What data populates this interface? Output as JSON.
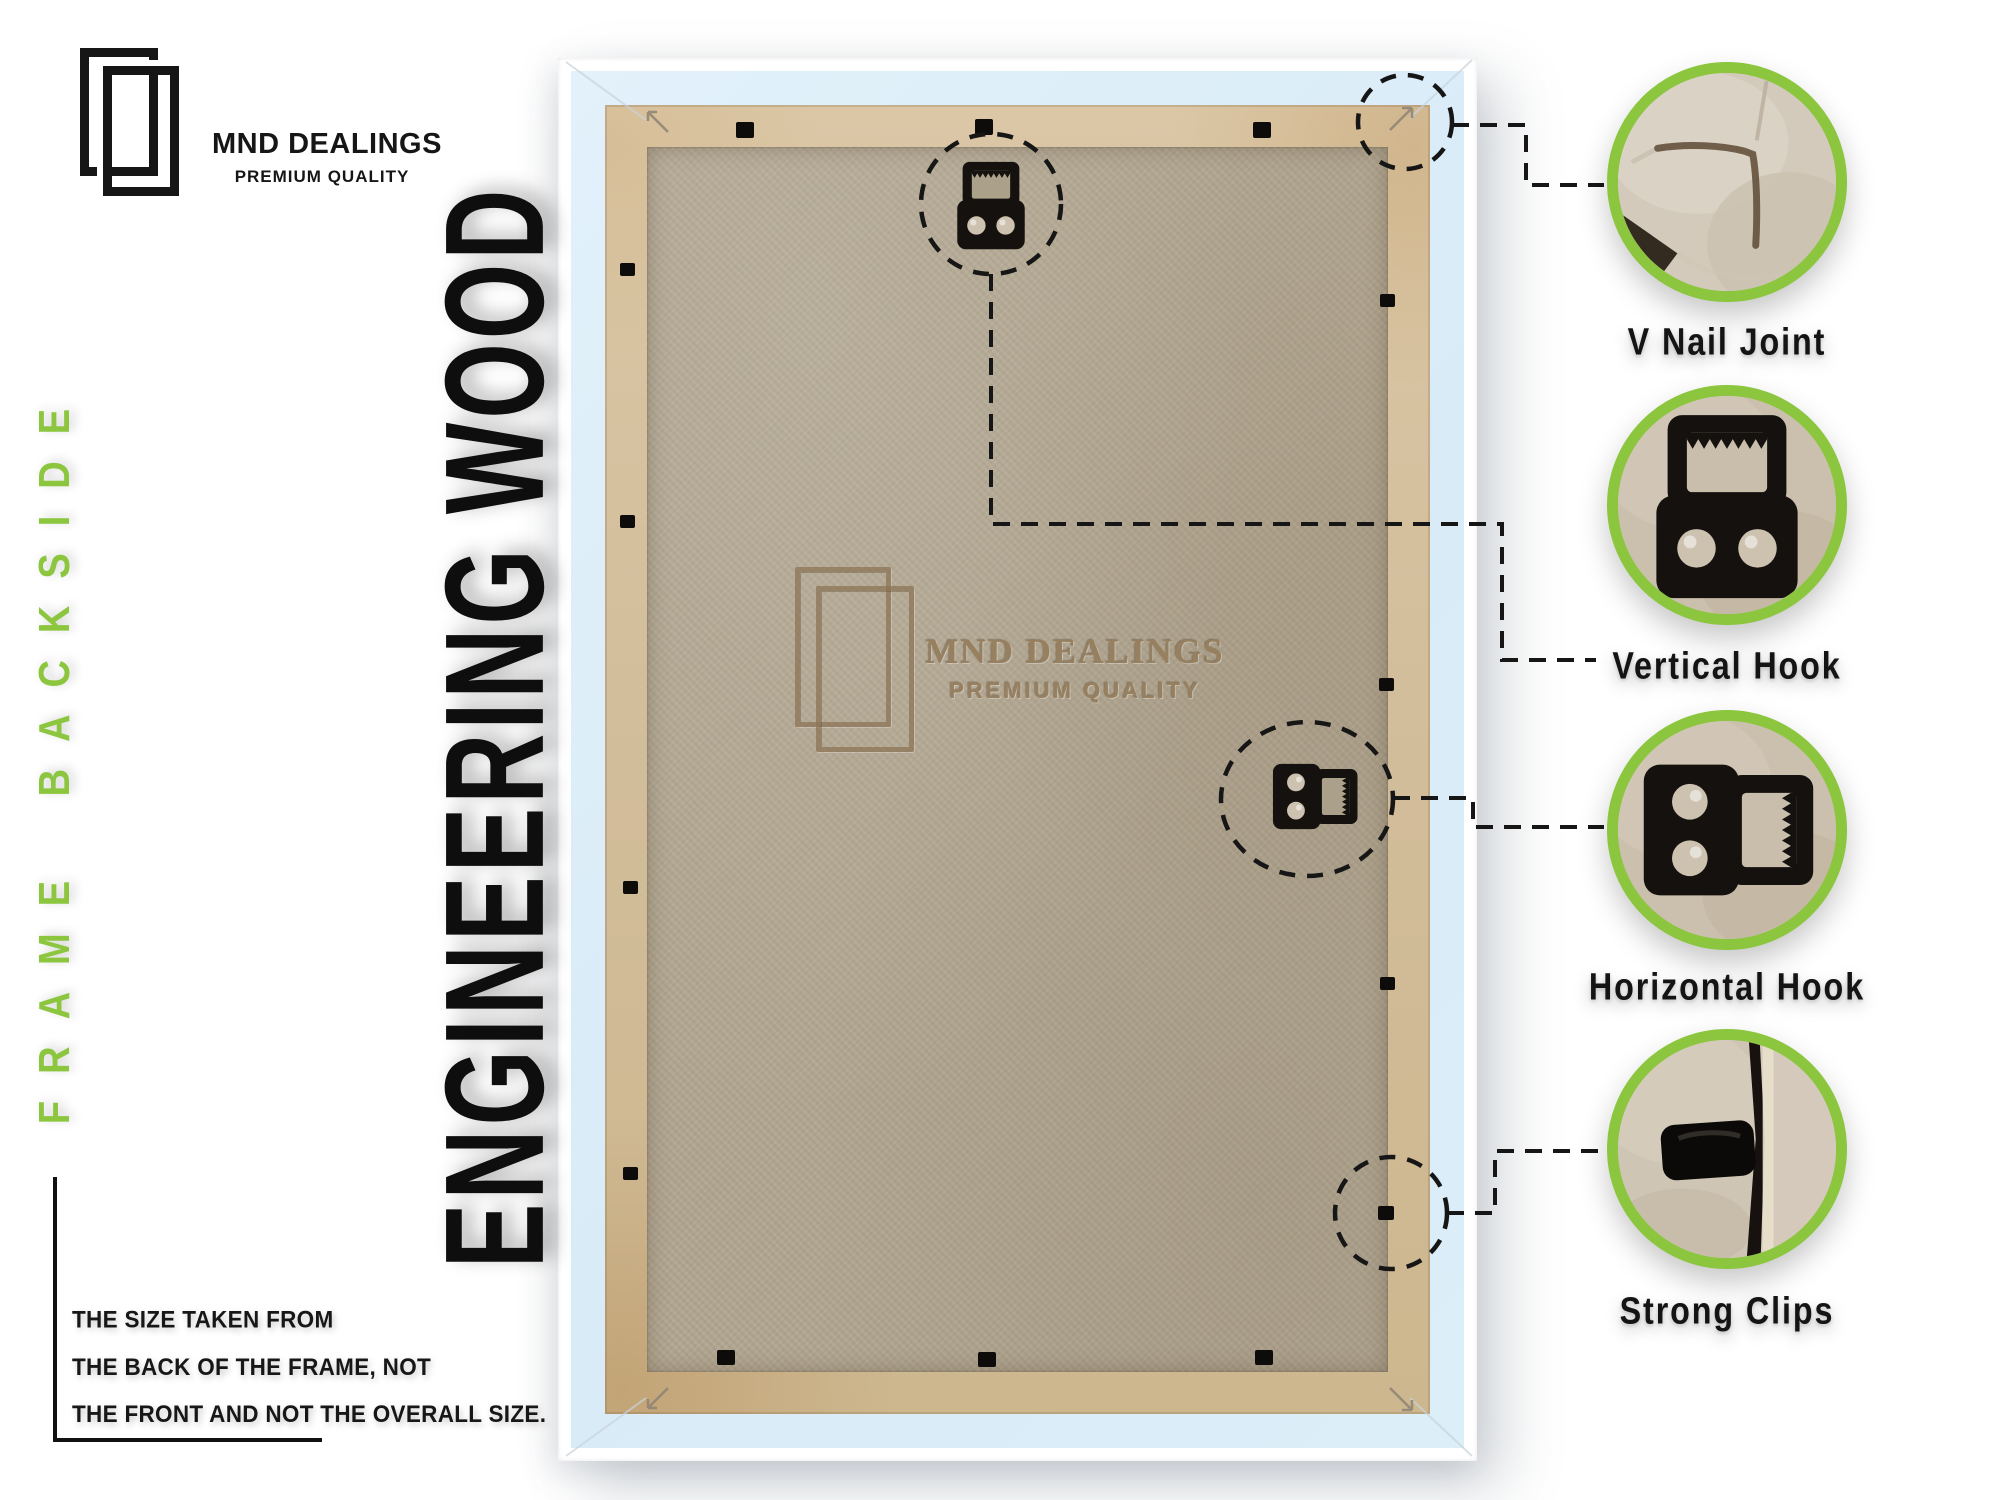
{
  "brand": {
    "name": "MND DEALINGS",
    "tagline": "PREMIUM QUALITY"
  },
  "side_banner": {
    "text": "FRAME BACKSIDE"
  },
  "material_banner": {
    "text": "ENGINEERING WOOD"
  },
  "watermark": {
    "name": "MND DEALINGS",
    "tagline": "PREMIUM QUALITY"
  },
  "size_note": {
    "lines": [
      "THE SIZE TAKEN FROM",
      "THE BACK OF THE FRAME, NOT",
      "THE FRONT AND NOT THE OVERALL SIZE."
    ]
  },
  "callouts": [
    {
      "id": "v-nail-joint",
      "label": "V Nail Joint"
    },
    {
      "id": "vertical-hook",
      "label": "Vertical Hook"
    },
    {
      "id": "horizontal-hook",
      "label": "Horizontal Hook"
    },
    {
      "id": "strong-clips",
      "label": "Strong Clips"
    }
  ],
  "colors": {
    "accent_green": "#8cc63f",
    "ink": "#121212",
    "frame_blue": "#dcecf7",
    "frame_white": "#ffffff",
    "wood_lip": "#d2bd9a",
    "mdf_board": "#b2a791",
    "emboss_brown": "#97805f"
  }
}
